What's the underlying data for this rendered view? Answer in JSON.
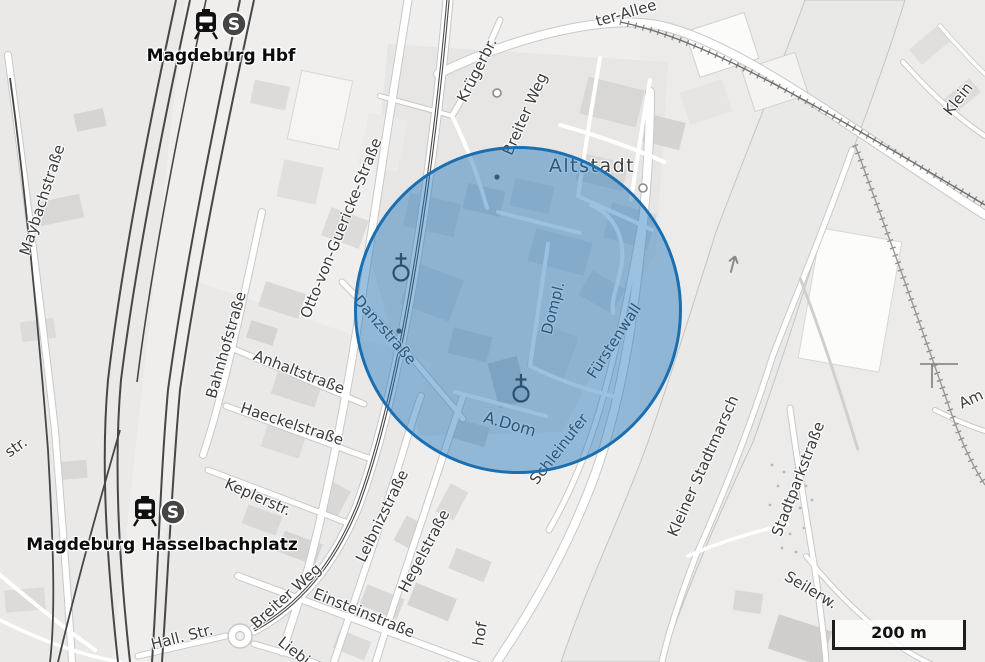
{
  "overlay": {
    "type": "radius-circle",
    "center_x": 521,
    "center_y": 313,
    "radius": 164,
    "fill": "rgba(31,117,186,0.45)",
    "stroke_color": "#1b6fb1",
    "stroke_width": 3
  },
  "scale_bar": {
    "label": "200 m"
  },
  "icons": {
    "sbahn_letter": "S"
  },
  "colors": {
    "land": "#efeeed",
    "river": "#e9e9e7",
    "railway": "#474747",
    "street_label": "#3b3b3b",
    "station_label": "#0b0b0b"
  },
  "map": {
    "labels": [
      {
        "t": "Magdeburg Hbf",
        "x": 221,
        "y": 56,
        "r": 0,
        "c": "station"
      },
      {
        "t": "Magdeburg Hasselbachplatz",
        "x": 162,
        "y": 545,
        "r": 0,
        "c": "station"
      },
      {
        "t": "Maybachstraße",
        "x": 42,
        "y": 200,
        "r": -72,
        "c": "street"
      },
      {
        "t": "Otto-von-Guericke-Straße",
        "x": 341,
        "y": 228,
        "r": -68,
        "c": "street"
      },
      {
        "t": "Bahnhofstraße",
        "x": 226,
        "y": 345,
        "r": -74,
        "c": "street"
      },
      {
        "t": "Anhaltstraße",
        "x": 299,
        "y": 372,
        "r": 21,
        "c": "street"
      },
      {
        "t": "Haeckelstraße",
        "x": 292,
        "y": 424,
        "r": 18,
        "c": "street"
      },
      {
        "t": "Keplerstr.",
        "x": 258,
        "y": 497,
        "r": 24,
        "c": "street"
      },
      {
        "t": "Danzstraße",
        "x": 385,
        "y": 330,
        "r": 49,
        "c": "street"
      },
      {
        "t": "Breiter Weg",
        "x": 525,
        "y": 114,
        "r": -66,
        "c": "street"
      },
      {
        "t": "Krügerbr.",
        "x": 477,
        "y": 70,
        "r": -63,
        "c": "street"
      },
      {
        "t": "ter-Allee",
        "x": 626,
        "y": 13,
        "r": -16,
        "c": "street"
      },
      {
        "t": "Altstadt",
        "x": 592,
        "y": 166,
        "r": 0,
        "c": "place"
      },
      {
        "t": "Dompl.",
        "x": 553,
        "y": 308,
        "r": -76,
        "c": "street"
      },
      {
        "t": "Fürstenwall",
        "x": 614,
        "y": 341,
        "r": -57,
        "c": "street"
      },
      {
        "t": "Schleinufer",
        "x": 559,
        "y": 449,
        "r": -52,
        "c": "street"
      },
      {
        "t": "A.Dom",
        "x": 510,
        "y": 424,
        "r": 16,
        "c": "street",
        "s": 16
      },
      {
        "t": "Leibnizstraße",
        "x": 382,
        "y": 516,
        "r": -64,
        "c": "street"
      },
      {
        "t": "Hegelstraße",
        "x": 424,
        "y": 551,
        "r": -62,
        "c": "street"
      },
      {
        "t": "Einsteinstraße",
        "x": 364,
        "y": 613,
        "r": 22,
        "c": "street"
      },
      {
        "t": "Breiter Weg",
        "x": 286,
        "y": 596,
        "r": -42,
        "c": "street"
      },
      {
        "t": "Liebi",
        "x": 294,
        "y": 651,
        "r": 38,
        "c": "street"
      },
      {
        "t": "Hall. Str.",
        "x": 182,
        "y": 637,
        "r": -14,
        "c": "street"
      },
      {
        "t": "hof",
        "x": 480,
        "y": 634,
        "r": -80,
        "c": "street"
      },
      {
        "t": "Kleiner Stadtmarsch",
        "x": 703,
        "y": 466,
        "r": -66,
        "c": "street"
      },
      {
        "t": "Stadtparkstraße",
        "x": 798,
        "y": 479,
        "r": -69,
        "c": "street"
      },
      {
        "t": "Seilerw.",
        "x": 811,
        "y": 590,
        "r": 31,
        "c": "street"
      },
      {
        "t": "Klein",
        "x": 958,
        "y": 99,
        "r": -52,
        "c": "street"
      },
      {
        "t": "Am",
        "x": 971,
        "y": 399,
        "r": -25,
        "c": "street"
      },
      {
        "t": "str.",
        "x": 16,
        "y": 447,
        "r": -35,
        "c": "street"
      }
    ]
  }
}
